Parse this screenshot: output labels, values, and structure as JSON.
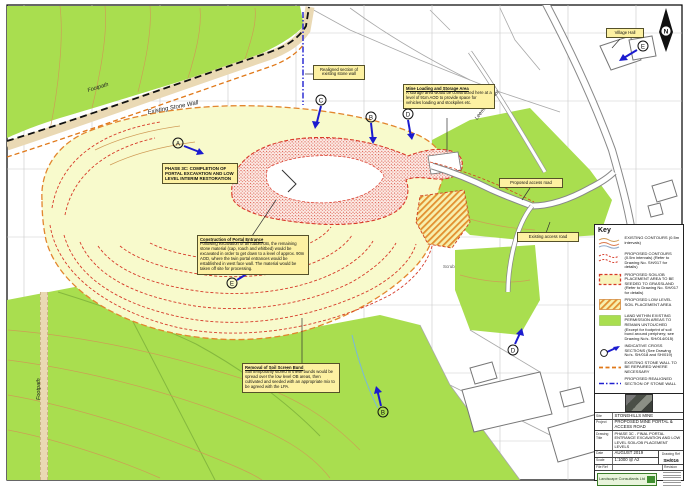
{
  "map_labels": {
    "footpath_top": "Footpath",
    "existing_stone_wall": "Existing Stone Wall",
    "leeming_manor": "Leeming Manor",
    "footpath_bottom": "Footpath",
    "scrub": "Scrub"
  },
  "annotations": {
    "realigned_wall": "Realigned section of existing stone wall",
    "village_hall": "Village Hall",
    "mine_loading_title": "Mine Loading and Storage Area",
    "mine_loading_body": "A storage area would be constructed here at a level of 91m AOD to provide space for vehicles loading and stockpiles etc.",
    "phase_3c": "PHASE 3C: COMPLETION OF PORTAL EXCAVATION AND LOW LEVEL INTERIM RESTORATION",
    "portal_title": "Construction of Portal Entrance",
    "portal_body": "Following excavation of all rubble/OB, the remaining stone material (cap, roach and whitbed) would be excavated in order to get down to a level of approx. 90m AOD, where the twin portal entrances would be established in west face wall. The material would be taken off site for processing.",
    "soil_bund_title": "Removal of Soil Screen Bund",
    "soil_bund_body": "Soil temporarily stored in these bunds would be spread over the low level OB areas, then cultivated and seeded with an appropriate mix to be agreed with the LPA.",
    "proposed_access_road": "Proposed access road",
    "existing_access_road": "Existing access road"
  },
  "north_arrow": {
    "label": "N"
  },
  "section_markers": [
    {
      "letter": "A"
    },
    {
      "letter": "C"
    },
    {
      "letter": "B"
    },
    {
      "letter": "D"
    },
    {
      "letter": "E"
    },
    {
      "letter": "B"
    },
    {
      "letter": "D"
    },
    {
      "letter": "E"
    }
  ],
  "key": {
    "title": "Key",
    "items": [
      {
        "symbol": "existing-contours-symbol",
        "text": "EXISTING CONTOURS (0.5m intervals)"
      },
      {
        "symbol": "proposed-contours-symbol",
        "text": "PROPOSED CONTOURS (0.5m intervals) (Refer to Drawing No. SH/017 for details)"
      },
      {
        "symbol": "soil-placement-symbol",
        "text": "PROPOSED SOIL/OB PLACEMENT AREA TO BE SEEDED TO GRASSLAND (Refer to Drawing No. SH/017 for details)"
      },
      {
        "symbol": "low-level-soil-symbol",
        "text": "PROPOSED LOW LEVEL SOIL PLACEMENT AREA"
      },
      {
        "symbol": "untouched-land-symbol",
        "text": "LAND WITHIN EXISTING PERMISSION AREAS TO REMAIN UNTOUCHED (Except for footprint of soil bund around periphery; see Drawing No's. SH/014/015)"
      },
      {
        "symbol": "cross-section-symbol",
        "text": "INDICATIVE CROSS SECTIONS (See Drawing No's. SH/018 and SH/019)"
      },
      {
        "symbol": "stone-wall-repair-symbol",
        "text": "EXISTING STONE WALL TO BE REPAIRED WHERE NECESSARY"
      },
      {
        "symbol": "realigned-wall-symbol",
        "text": "PROPOSED REALIGNED SECTION OF STONE WALL"
      }
    ]
  },
  "title_block": {
    "site_label": "Site",
    "site_value": "STONEHILLS MINE",
    "project_label": "Project",
    "project_value": "PROPOSED MINE PORTAL & ACCESS ROAD",
    "drawing_title_label": "Drawing Title",
    "drawing_title_value": "PHASE 3C - FINAL PORTAL ENTRANCE EXCAVATION AND LOW LEVEL SOIL/OB PLACEMENT LEVELS",
    "date_label": "Date",
    "date_value": "AUGUST 2019",
    "scale_label": "Scale",
    "scale_value": "1:1000 @ A2",
    "drawing_ref_label": "Drawing Ref",
    "drawing_ref_value": "SH/016",
    "file_ref_label": "File Ref",
    "revision_label": "Revision",
    "consultant": "Landscape Consultants Ltd"
  }
}
